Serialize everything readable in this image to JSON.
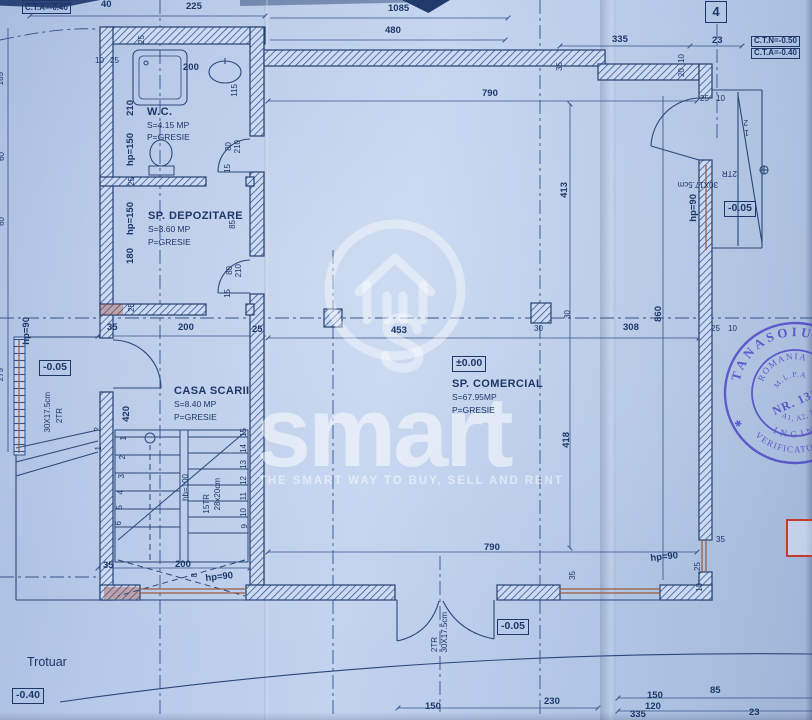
{
  "colors": {
    "paper": "#b5c8e8",
    "ink": "#1c3768",
    "sill_red": "#9b5a40",
    "marker_red": "#c23b2e",
    "stamp_blue": "#4b43c4",
    "watermark": "#ffffff"
  },
  "watermark": {
    "logo": "smart",
    "tagline": "THE SMART WAY TO BUY, SELL AND RENT"
  },
  "stamp": {
    "outer_top": "TANASOIU",
    "outer_bottom": "VERIFICATOR PROIECTE",
    "ring_bottom": "INGINER",
    "inner_top": "ROMANIA",
    "inner_line2": "M.L.P.A.",
    "number": "NR. 1315",
    "inner_line4": "A1, A2, A3",
    "star": "✱"
  },
  "rooms": [
    {
      "name": "W.C.",
      "area": "S=4.15 MP",
      "floor": "P=GRESIE"
    },
    {
      "name": "SP. DEPOZITARE",
      "area": "S=3.60 MP",
      "floor": "P=GRESIE"
    },
    {
      "name": "CASA SCARII",
      "area": "S=8.40 MP",
      "floor": "P=GRESIE"
    },
    {
      "name": "SP. COMERCIAL",
      "area": "S=67.95MP",
      "floor": "P=GRESIE"
    }
  ],
  "levels": {
    "ground": "±0.00",
    "entry": "-0.05",
    "sidewalk": "-0.40"
  },
  "grid_axis": "4",
  "labels": [
    {
      "t": "C.T.N=-0.50",
      "x": 22,
      "y": -10,
      "c": "boxed sm",
      "n": "level-marker"
    },
    {
      "t": "C.T.A=-0.40",
      "x": 22,
      "y": 3,
      "c": "boxed sm",
      "n": "level-marker"
    },
    {
      "t": "40",
      "x": 101,
      "y": 0
    },
    {
      "t": "225",
      "x": 186,
      "y": 2
    },
    {
      "t": "1085",
      "x": 388,
      "y": 4
    },
    {
      "t": "480",
      "x": 385,
      "y": 26
    },
    {
      "t": "4",
      "x": 705,
      "y": 1,
      "c": "bubble",
      "n": "grid-axis-bubble"
    },
    {
      "t": "335",
      "x": 612,
      "y": 35
    },
    {
      "t": "23",
      "x": 712,
      "y": 36
    },
    {
      "t": "C.T.N=-0.50",
      "x": 751,
      "y": 36,
      "c": "boxed sm",
      "n": "level-marker"
    },
    {
      "t": "C.T.A=-0.40",
      "x": 751,
      "y": 48,
      "c": "boxed sm",
      "n": "level-marker"
    },
    {
      "t": "35",
      "x": 556,
      "y": 62,
      "r": -90,
      "c": "t"
    },
    {
      "t": "10",
      "x": 678,
      "y": 54,
      "r": -90,
      "c": "t"
    },
    {
      "t": "20",
      "x": 678,
      "y": 68,
      "r": -90,
      "c": "t"
    },
    {
      "t": "25",
      "x": 700,
      "y": 95,
      "c": "t"
    },
    {
      "t": "10",
      "x": 716,
      "y": 95,
      "c": "t"
    },
    {
      "t": "790",
      "x": 482,
      "y": 89
    },
    {
      "t": "10",
      "x": 95,
      "y": 57,
      "c": "t"
    },
    {
      "t": "25",
      "x": 110,
      "y": 57,
      "c": "t"
    },
    {
      "t": "25",
      "x": 138,
      "y": 35,
      "r": -90,
      "c": "t"
    },
    {
      "t": "200",
      "x": 183,
      "y": 63
    },
    {
      "t": "115",
      "x": 231,
      "y": 84,
      "r": -90,
      "c": "t"
    },
    {
      "t": "210",
      "x": 126,
      "y": 100,
      "r": -90
    },
    {
      "t": "W.C.",
      "x": 147,
      "y": 106,
      "c": "room",
      "n": "room-name"
    },
    {
      "t": "S=4.15 MP",
      "x": 147,
      "y": 121,
      "c": "sub",
      "n": "room-area"
    },
    {
      "t": "P=GRESIE",
      "x": 147,
      "y": 133,
      "c": "sub",
      "n": "room-floor"
    },
    {
      "t": "hp=150",
      "x": 126,
      "y": 133,
      "r": -90
    },
    {
      "t": "80",
      "x": 225,
      "y": 142,
      "r": -90,
      "c": "t"
    },
    {
      "t": "210",
      "x": 234,
      "y": 140,
      "r": -90,
      "c": "t"
    },
    {
      "t": "15",
      "x": 224,
      "y": 164,
      "r": -90,
      "c": "t"
    },
    {
      "t": "25",
      "x": 128,
      "y": 177,
      "r": -90,
      "c": "t"
    },
    {
      "t": "SP. DEPOZITARE",
      "x": 148,
      "y": 210,
      "c": "room",
      "n": "room-name"
    },
    {
      "t": "S=3.60 MP",
      "x": 148,
      "y": 225,
      "c": "sub",
      "n": "room-area"
    },
    {
      "t": "P=GRESIE",
      "x": 148,
      "y": 238,
      "c": "sub",
      "n": "room-floor"
    },
    {
      "t": "hp=150",
      "x": 126,
      "y": 202,
      "r": -90
    },
    {
      "t": "180",
      "x": 126,
      "y": 248,
      "r": -90
    },
    {
      "t": "85",
      "x": 229,
      "y": 220,
      "r": -90,
      "c": "t"
    },
    {
      "t": "80",
      "x": 226,
      "y": 266,
      "r": -90,
      "c": "t"
    },
    {
      "t": "210",
      "x": 235,
      "y": 264,
      "r": -90,
      "c": "t"
    },
    {
      "t": "15",
      "x": 224,
      "y": 289,
      "r": -90,
      "c": "t"
    },
    {
      "t": "25",
      "x": 128,
      "y": 303,
      "r": -90,
      "c": "t"
    },
    {
      "t": "35",
      "x": 107,
      "y": 323
    },
    {
      "t": "200",
      "x": 178,
      "y": 323
    },
    {
      "t": "25",
      "x": 252,
      "y": 325
    },
    {
      "t": "CASA SCARII",
      "x": 174,
      "y": 385,
      "c": "room",
      "n": "room-name"
    },
    {
      "t": "S=8.40 MP",
      "x": 174,
      "y": 400,
      "c": "sub",
      "n": "room-area"
    },
    {
      "t": "P=GRESIE",
      "x": 174,
      "y": 413,
      "c": "sub",
      "n": "room-floor"
    },
    {
      "t": "420",
      "x": 122,
      "y": 406,
      "r": -90
    },
    {
      "t": "1",
      "x": 120,
      "y": 436,
      "r": -90,
      "c": "t"
    },
    {
      "t": "2",
      "x": 119,
      "y": 455,
      "r": -90,
      "c": "t"
    },
    {
      "t": "3",
      "x": 118,
      "y": 474,
      "r": -90,
      "c": "t"
    },
    {
      "t": "4",
      "x": 117,
      "y": 490,
      "r": -90,
      "c": "t"
    },
    {
      "t": "5",
      "x": 116,
      "y": 505,
      "r": -90,
      "c": "t"
    },
    {
      "t": "6",
      "x": 115,
      "y": 521,
      "r": -90,
      "c": "t"
    },
    {
      "t": "15",
      "x": 240,
      "y": 428,
      "r": -90,
      "c": "t"
    },
    {
      "t": "14",
      "x": 240,
      "y": 444,
      "r": -90,
      "c": "t"
    },
    {
      "t": "13",
      "x": 240,
      "y": 460,
      "r": -90,
      "c": "t"
    },
    {
      "t": "12",
      "x": 240,
      "y": 476,
      "r": -90,
      "c": "t"
    },
    {
      "t": "11",
      "x": 240,
      "y": 492,
      "r": -90,
      "c": "t"
    },
    {
      "t": "10",
      "x": 240,
      "y": 508,
      "r": -90,
      "c": "t"
    },
    {
      "t": "9",
      "x": 241,
      "y": 524,
      "r": -90,
      "c": "t"
    },
    {
      "t": "15TR",
      "x": 203,
      "y": 494,
      "r": -90,
      "c": "t"
    },
    {
      "t": "28x20cm",
      "x": 214,
      "y": 478,
      "r": -90,
      "c": "t"
    },
    {
      "t": "hb=100",
      "x": 182,
      "y": 474,
      "r": -90,
      "c": "t"
    },
    {
      "t": "35",
      "x": 103,
      "y": 561
    },
    {
      "t": "200",
      "x": 175,
      "y": 560
    },
    {
      "t": "8",
      "x": 191,
      "y": 573,
      "r": -90,
      "c": "t"
    },
    {
      "t": "hp=90",
      "x": 205,
      "y": 574,
      "r": -6
    },
    {
      "t": "Trotuar",
      "x": 27,
      "y": 656,
      "c": "plain-lg",
      "n": "sidewalk-label"
    },
    {
      "t": "-0.40",
      "x": 12,
      "y": 688,
      "c": "boxed",
      "n": "level-marker"
    },
    {
      "t": "hp=90",
      "x": 22,
      "y": 317,
      "r": -90
    },
    {
      "t": "-0.05",
      "x": 39,
      "y": 360,
      "c": "boxed",
      "n": "level-marker"
    },
    {
      "t": "30X17.5cm",
      "x": 44,
      "y": 392,
      "r": -90,
      "c": "t"
    },
    {
      "t": "2TR",
      "x": 56,
      "y": 408,
      "r": -90,
      "c": "t"
    },
    {
      "t": "2",
      "x": 94,
      "y": 427,
      "r": -90,
      "c": "t"
    },
    {
      "t": "1",
      "x": 95,
      "y": 446,
      "r": -90,
      "c": "t"
    },
    {
      "t": "185",
      "x": -3,
      "y": 72,
      "r": -90,
      "c": "t"
    },
    {
      "t": "60",
      "x": -2,
      "y": 152,
      "r": -90,
      "c": "t"
    },
    {
      "t": "60",
      "x": -2,
      "y": 217,
      "r": -90,
      "c": "t"
    },
    {
      "t": "275",
      "x": -3,
      "y": 368,
      "r": -90,
      "c": "t"
    },
    {
      "t": "±0.00",
      "x": 452,
      "y": 356,
      "c": "boxed",
      "n": "level-marker"
    },
    {
      "t": "SP. COMERCIAL",
      "x": 452,
      "y": 378,
      "c": "room",
      "n": "room-name"
    },
    {
      "t": "S=67.95MP",
      "x": 452,
      "y": 393,
      "c": "sub",
      "n": "room-area"
    },
    {
      "t": "P=GRESIE",
      "x": 452,
      "y": 406,
      "c": "sub",
      "n": "room-floor"
    },
    {
      "t": "453",
      "x": 391,
      "y": 326
    },
    {
      "t": "30",
      "x": 534,
      "y": 325,
      "c": "t"
    },
    {
      "t": "308",
      "x": 623,
      "y": 323
    },
    {
      "t": "413",
      "x": 560,
      "y": 182,
      "r": -90
    },
    {
      "t": "30",
      "x": 564,
      "y": 310,
      "r": -90,
      "c": "t"
    },
    {
      "t": "418",
      "x": 562,
      "y": 432,
      "r": -90
    },
    {
      "t": "860",
      "x": 654,
      "y": 306,
      "r": -90
    },
    {
      "t": "790",
      "x": 484,
      "y": 543
    },
    {
      "t": "35",
      "x": 569,
      "y": 571,
      "r": -90,
      "c": "t"
    },
    {
      "t": "25",
      "x": 711,
      "y": 325,
      "c": "t"
    },
    {
      "t": "10",
      "x": 728,
      "y": 325,
      "c": "t"
    },
    {
      "t": "2TR",
      "x": 737,
      "y": 177,
      "r": 180,
      "c": "t"
    },
    {
      "t": "30X17.5cm",
      "x": 718,
      "y": 188,
      "r": 180,
      "c": "t"
    },
    {
      "t": "-0.05",
      "x": 724,
      "y": 201,
      "c": "boxed",
      "n": "level-marker"
    },
    {
      "t": "hp=90",
      "x": 689,
      "y": 194,
      "r": -90
    },
    {
      "t": "2",
      "x": 748,
      "y": 126,
      "r": 180,
      "c": "t"
    },
    {
      "t": "1",
      "x": 749,
      "y": 136,
      "r": 180,
      "c": "t"
    },
    {
      "t": "hp=90",
      "x": 650,
      "y": 554,
      "r": -6
    },
    {
      "t": "35",
      "x": 716,
      "y": 536,
      "c": "t"
    },
    {
      "t": "25",
      "x": 694,
      "y": 562,
      "r": -90,
      "c": "t"
    },
    {
      "t": "10",
      "x": 696,
      "y": 583,
      "r": -90,
      "c": "t"
    },
    {
      "t": "150",
      "x": 647,
      "y": 691
    },
    {
      "t": "120",
      "x": 645,
      "y": 702
    },
    {
      "t": "335",
      "x": 630,
      "y": 710
    },
    {
      "t": "85",
      "x": 710,
      "y": 686
    },
    {
      "t": "23",
      "x": 749,
      "y": 708
    },
    {
      "t": "150",
      "x": 425,
      "y": 702
    },
    {
      "t": "230",
      "x": 544,
      "y": 697
    },
    {
      "t": "-0.05",
      "x": 497,
      "y": 619,
      "c": "boxed",
      "n": "level-marker"
    },
    {
      "t": "30X17.5cm",
      "x": 441,
      "y": 612,
      "r": -90,
      "c": "t"
    },
    {
      "t": "2TR",
      "x": 431,
      "y": 637,
      "r": -90,
      "c": "t"
    }
  ]
}
